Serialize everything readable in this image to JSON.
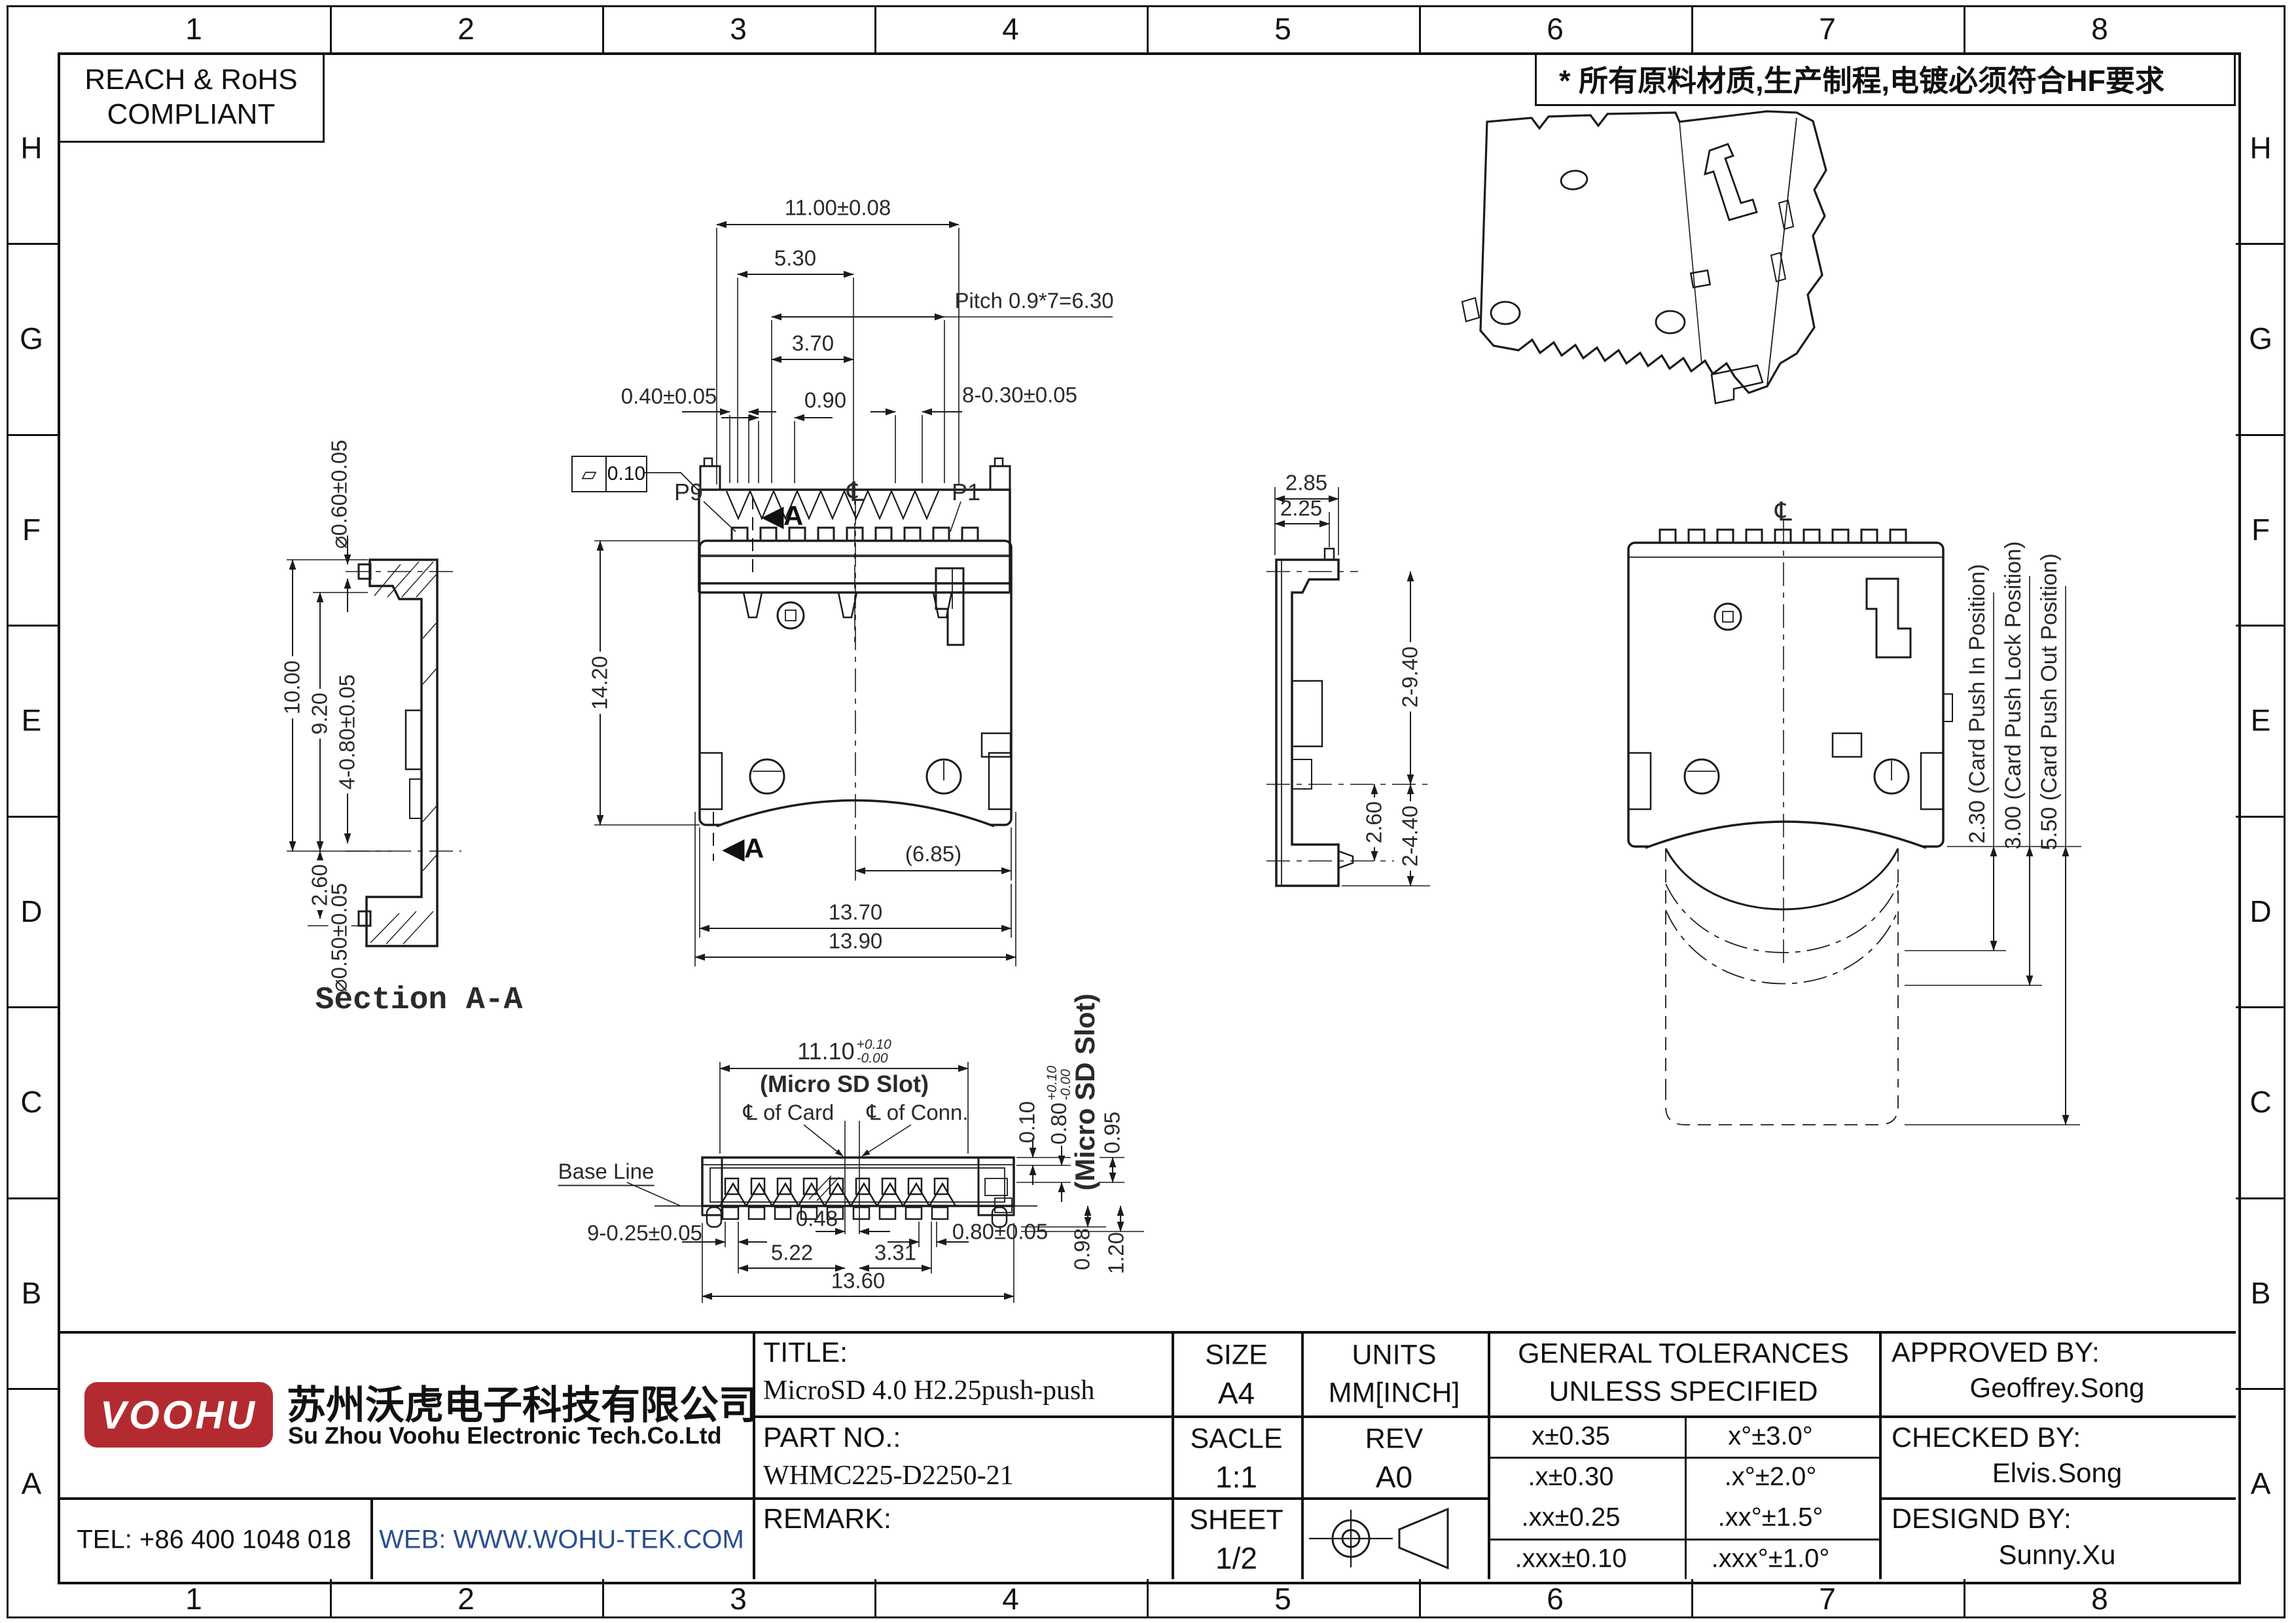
{
  "frame": {
    "cols": [
      "1",
      "2",
      "3",
      "4",
      "5",
      "6",
      "7",
      "8"
    ],
    "rows": [
      "H",
      "G",
      "F",
      "E",
      "D",
      "C",
      "B",
      "A"
    ]
  },
  "badges": {
    "reach_line1": "REACH & RoHS",
    "reach_line2": "COMPLIANT",
    "cn_note": "* 所有原料材质,生产制程,电镀必须符合HF要求"
  },
  "views": {
    "front": {
      "d11": "11.00±0.08",
      "d530": "5.30",
      "pitch": "Pitch 0.9*7=6.30",
      "d370": "3.70",
      "d090": "0.90",
      "d040": "0.40±0.05",
      "d830": "8-0.30±0.05",
      "fcf_symbol": "▱",
      "fcf_value": "0.10"
    },
    "section": {
      "caption": "Section A-A",
      "dia_top": "⌀0.60±0.05",
      "d1000": "10.00",
      "d920": "9.20",
      "d480": "4-0.80±0.05",
      "d260": "2.60",
      "dia_bot": "⌀0.50±0.05"
    },
    "main": {
      "p9": "P9",
      "p1": "P1",
      "cl": "℄",
      "section_arrow": "◀",
      "section_letter": "A",
      "d1420": "14.20",
      "d685": "(6.85)",
      "d1370": "13.70",
      "d1390": "13.90"
    },
    "side": {
      "d285": "2.85",
      "d225": "2.25",
      "d940": "2-9.40",
      "d260": "2.60",
      "d440": "2-4.40"
    },
    "card": {
      "cl": "℄",
      "pos_in": "2.30 (Card Push In Position)",
      "pos_lock": "3.00 (Card Push Lock Position)",
      "pos_out": "5.50 (Card Push Out Position)"
    },
    "bottom": {
      "d1110": "11.10",
      "d1110_up": "+0.10",
      "d1110_dn": "-0.00",
      "slot_note1": "(Micro SD Slot)",
      "cl_card": "℄ of Card",
      "cl_conn": "℄ of Conn.",
      "d010": "0.10",
      "d080t": "0.80",
      "d080t_up": "+0.10",
      "d080t_dn": "-0.00",
      "slot_note2": "(Micro SD Slot)",
      "d095": "0.95",
      "base_line": "Base Line",
      "d925": "9-0.25±0.05",
      "d048": "0.48",
      "d522": "5.22",
      "d331": "3.31",
      "d080": "0.80±0.05",
      "d098": "0.98",
      "d120": "1.20",
      "d1360": "13.60"
    }
  },
  "title_block": {
    "logo_text": "VOOHU",
    "company_cn": "苏州沃虎电子科技有限公司",
    "company_en": "Su Zhou Voohu Electronic Tech.Co.Ltd",
    "tel": "TEL: +86 400 1048 018",
    "web": "WEB: WWW.WOHU-TEK.COM",
    "title_label": "TITLE:",
    "title_value": "MicroSD 4.0 H2.25push-push",
    "part_label": "PART NO.:",
    "part_value": "WHMC225-D2250-21",
    "remark_label": "REMARK:",
    "size_label": "SIZE",
    "size_value": "A4",
    "units_label": "UNITS",
    "units_value": "MM[INCH]",
    "scale_label": "SACLE",
    "scale_value": "1:1",
    "rev_label": "REV",
    "rev_value": "A0",
    "sheet_label": "SHEET",
    "sheet_value": "1/2",
    "tol_header1": "GENERAL TOLERANCES",
    "tol_header2": "UNLESS SPECIFIED",
    "tol_rows": [
      [
        "x±0.35",
        "x°±3.0°"
      ],
      [
        ".x±0.30",
        ".x°±2.0°"
      ],
      [
        ".xx±0.25",
        ".xx°±1.5°"
      ],
      [
        ".xxx±0.10",
        ".xxx°±1.0°"
      ]
    ],
    "approved_label": "APPROVED BY:",
    "approved_value": "Geoffrey.Song",
    "checked_label": "CHECKED BY:",
    "checked_value": "Elvis.Song",
    "designed_label": "DESIGND BY:",
    "designed_value": "Sunny.Xu"
  },
  "colors": {
    "accent_red": "#b32b30",
    "web_blue": "#2a4f8f",
    "line": "#1b1b1b"
  }
}
